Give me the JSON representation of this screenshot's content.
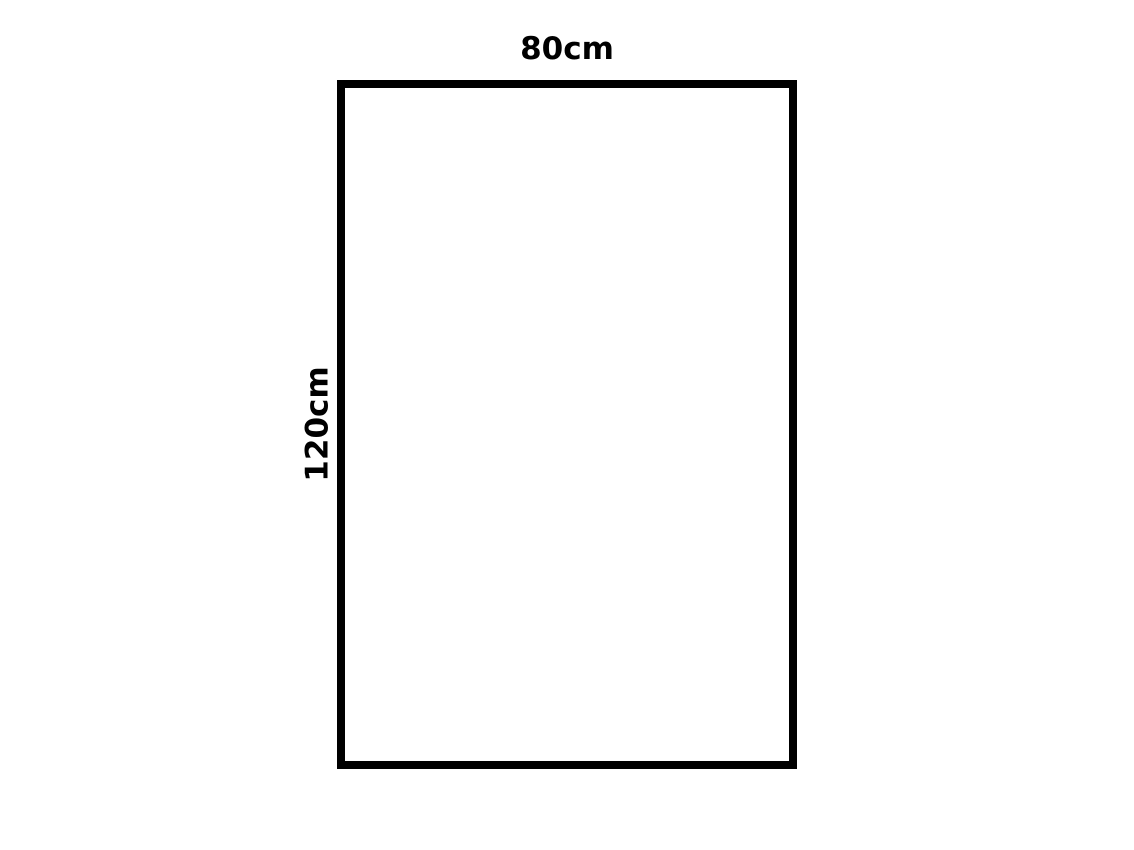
{
  "diagram": {
    "type": "rectangle-dimension-figure",
    "rectangle": {
      "border_color": "#000000",
      "fill_color": "#ffffff",
      "width_label": "80cm",
      "height_label": "120cm",
      "width_value_cm": 80,
      "height_value_cm": 120
    }
  }
}
